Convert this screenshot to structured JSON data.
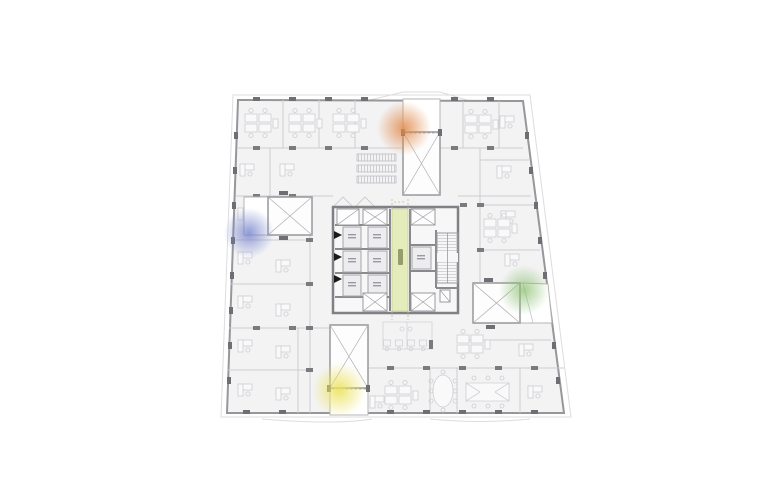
{
  "plan": {
    "title": "office-tower-typical-floor-plan",
    "colors": {
      "background": "#ffffff",
      "floor_fill": "#f3f3f4",
      "wall": "#96969b",
      "partition": "#cdcdd1",
      "furniture": "#d0d0d5",
      "column": "#6e6e73",
      "core_wall": "#808085",
      "core_fill": "#f7f7f8",
      "corridor_fill": "#e4ecbb",
      "shaft_fill": "#fdfdfd",
      "canopy": "#dddde0"
    },
    "core": {
      "corridor_fill": "#e4ecbb",
      "elevator_count": 7,
      "stair_count": 1,
      "call_triangle_count": 3
    },
    "highlights": [
      {
        "name": "north-shaft-highlight",
        "color": "#e08a4a",
        "cx": 405,
        "cy": 128,
        "r": 27
      },
      {
        "name": "west-shaft-highlight",
        "color": "#7583cb",
        "cx": 249,
        "cy": 233,
        "r": 25
      },
      {
        "name": "east-shaft-highlight",
        "color": "#8cc06f",
        "cx": 524,
        "cy": 290,
        "r": 25
      },
      {
        "name": "south-shaft-highlight",
        "color": "#ece35f",
        "cx": 339,
        "cy": 390,
        "r": 27
      }
    ]
  }
}
